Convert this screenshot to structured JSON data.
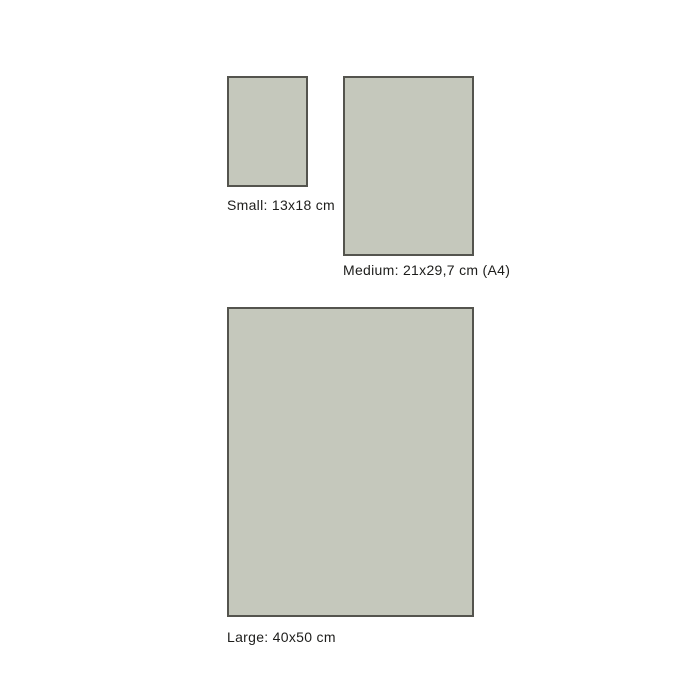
{
  "colors": {
    "background": "#ffffff",
    "swatch_fill": "#c5c8bc",
    "swatch_border": "#54544e",
    "label_text": "#1d1d1b"
  },
  "size_guide": {
    "sizes": [
      {
        "id": "small",
        "label": "Small: 13x18 cm",
        "width_cm": "13",
        "height_cm": "18"
      },
      {
        "id": "medium",
        "label": "Medium: 21x29,7 cm (A4)",
        "width_cm": "21",
        "height_cm": "29,7"
      },
      {
        "id": "large",
        "label": "Large: 40x50 cm",
        "width_cm": "40",
        "height_cm": "50"
      }
    ]
  }
}
